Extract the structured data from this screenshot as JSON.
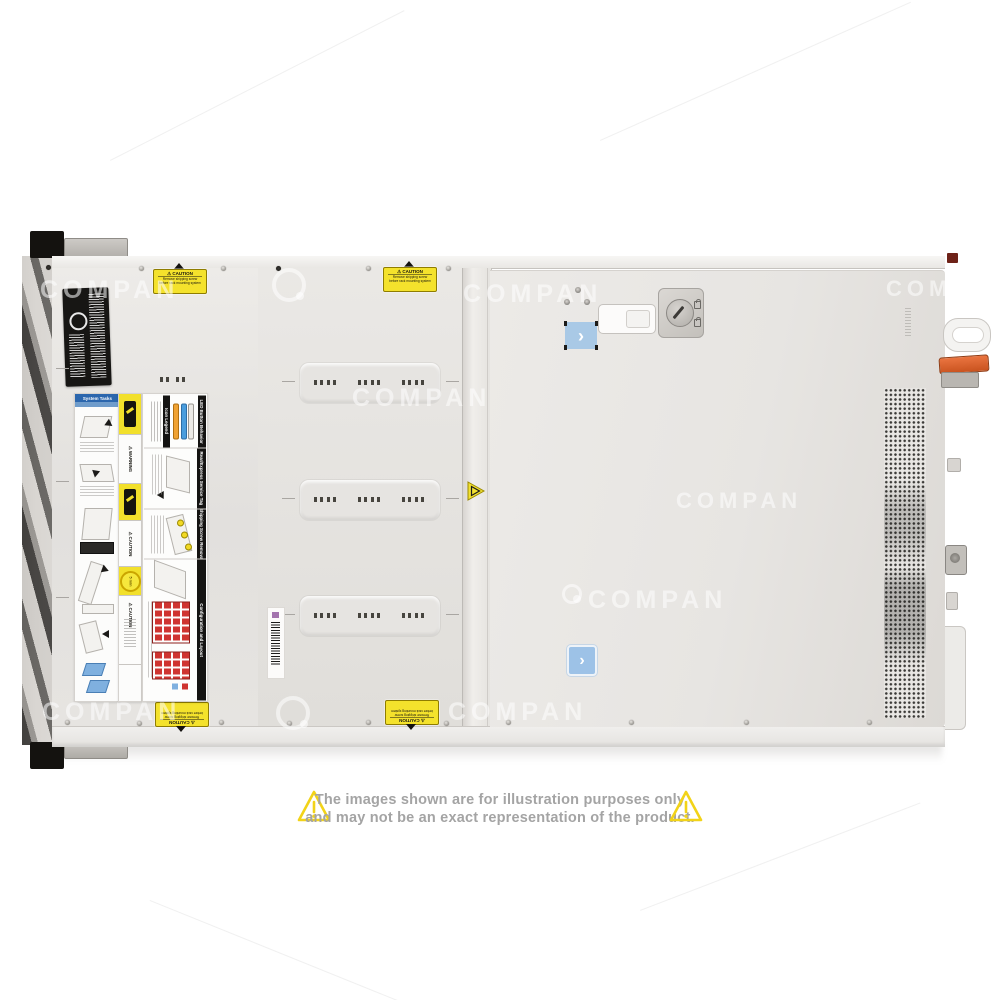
{
  "watermark": {
    "text": "COMPAN"
  },
  "disclaimer": {
    "line1": "The images shown are for illustration purposes only",
    "line2": "and may not be an exact representation of the product."
  },
  "caution_label": {
    "title": "⚠ CAUTION",
    "line1": "Remove shipping screw",
    "line2": "before rack mounting system"
  },
  "service_labels": {
    "system_tasks": "System Tasks",
    "warning": "⚠ WARNING",
    "caution": "⚠ CAUTION",
    "five_min": "5 min",
    "sections": [
      {
        "title": "LED Button Behavior"
      },
      {
        "title": "Icon Legend"
      },
      {
        "title": "Rear/Express Service Tag"
      },
      {
        "title": "Shipping Screw Removal"
      },
      {
        "title": "Configuration and Layout"
      }
    ]
  },
  "touch_points": {
    "chevron": "›"
  }
}
